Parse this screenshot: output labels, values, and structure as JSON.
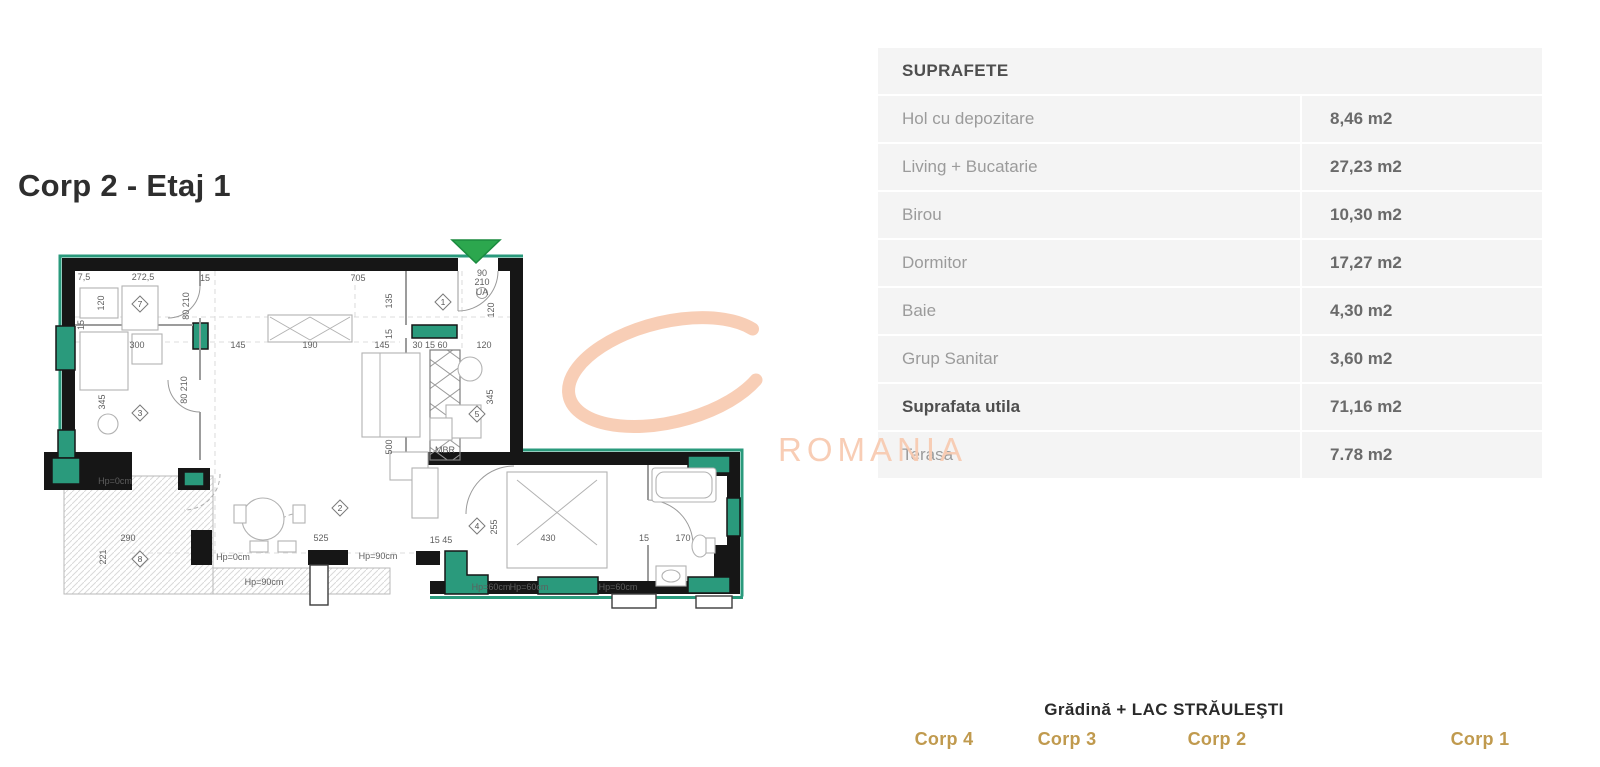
{
  "title": "Corp 2 - Etaj 1",
  "watermark": {
    "text": "ROMANIA"
  },
  "table": {
    "header": "SUPRAFETE",
    "rows": [
      {
        "label": "Hol cu depozitare",
        "value": "8,46 m2",
        "bold": false
      },
      {
        "label": "Living + Bucatarie",
        "value": "27,23 m2",
        "bold": false
      },
      {
        "label": "Birou",
        "value": "10,30 m2",
        "bold": false
      },
      {
        "label": "Dormitor",
        "value": "17,27 m2",
        "bold": false
      },
      {
        "label": "Baie",
        "value": "4,30 m2",
        "bold": false
      },
      {
        "label": "Grup Sanitar",
        "value": "3,60 m2",
        "bold": false
      },
      {
        "label": "Suprafata utila",
        "value": "71,16 m2",
        "bold": true
      },
      {
        "label": "Terasa",
        "value": "7.78 m2",
        "bold": false
      }
    ]
  },
  "site": {
    "caption": "Grădină + LAC STRĂULEŞTI",
    "caption_x": 1164,
    "corps": [
      {
        "label": "Corp 4",
        "x": 893,
        "y": 549,
        "scale": 1.05,
        "label_x": 944,
        "highlighted": false
      },
      {
        "label": "Corp 3",
        "x": 1002,
        "y": 551,
        "scale": 0.88,
        "label_x": 1067,
        "highlighted": false
      },
      {
        "label": "Corp 2",
        "x": 1150,
        "y": 552,
        "scale": 0.8,
        "label_x": 1217,
        "highlighted": true
      },
      {
        "label": "Corp 1",
        "x": 1398,
        "y": 549,
        "scale": 0.82,
        "label_x": 1480,
        "highlighted": false
      }
    ]
  },
  "floorplan": {
    "entrance_icon": "entrance-triangle",
    "rooms": [
      {
        "n": "1",
        "x": 443,
        "y": 302
      },
      {
        "n": "2",
        "x": 340,
        "y": 508
      },
      {
        "n": "3",
        "x": 140,
        "y": 413
      },
      {
        "n": "4",
        "x": 477,
        "y": 526
      },
      {
        "n": "5",
        "x": 477,
        "y": 414
      },
      {
        "n": "7",
        "x": 140,
        "y": 304
      },
      {
        "n": "8",
        "x": 140,
        "y": 559
      }
    ],
    "dims": [
      {
        "t": "7,5",
        "x": 84,
        "y": 280
      },
      {
        "t": "272,5",
        "x": 143,
        "y": 280
      },
      {
        "t": "15",
        "x": 205,
        "y": 281
      },
      {
        "t": "705",
        "x": 358,
        "y": 281
      },
      {
        "t": "120",
        "x": 104,
        "y": 303,
        "r": -90
      },
      {
        "t": "135",
        "x": 392,
        "y": 301,
        "r": -90
      },
      {
        "t": "90",
        "x": 482,
        "y": 276,
        "s": 7
      },
      {
        "t": "210",
        "x": 482,
        "y": 285,
        "s": 7
      },
      {
        "t": "UA",
        "x": 482,
        "y": 295,
        "s": 5
      },
      {
        "t": "120",
        "x": 494,
        "y": 310,
        "r": -90
      },
      {
        "t": "15",
        "x": 84,
        "y": 325,
        "r": -90,
        "s": 7
      },
      {
        "t": "300",
        "x": 137,
        "y": 348
      },
      {
        "t": "145",
        "x": 238,
        "y": 348
      },
      {
        "t": "190",
        "x": 310,
        "y": 348
      },
      {
        "t": "145",
        "x": 382,
        "y": 348
      },
      {
        "t": "30 15 60",
        "x": 430,
        "y": 348,
        "s": 8
      },
      {
        "t": "120",
        "x": 484,
        "y": 348
      },
      {
        "t": "15",
        "x": 392,
        "y": 334,
        "r": -90,
        "s": 8
      },
      {
        "t": "345",
        "x": 105,
        "y": 402,
        "r": -90
      },
      {
        "t": "80 210",
        "x": 189,
        "y": 306,
        "r": -90,
        "s": 7
      },
      {
        "t": "80 210",
        "x": 187,
        "y": 390,
        "r": -90,
        "s": 7
      },
      {
        "t": "345",
        "x": 493,
        "y": 397,
        "r": -90
      },
      {
        "t": "500",
        "x": 392,
        "y": 447,
        "r": -90
      },
      {
        "t": "MBR",
        "x": 445,
        "y": 453,
        "s": 6
      },
      {
        "t": "Hp=0cm",
        "x": 115,
        "y": 484,
        "s": 7
      },
      {
        "t": "290",
        "x": 128,
        "y": 541
      },
      {
        "t": "221",
        "x": 106,
        "y": 557,
        "r": -90
      },
      {
        "t": "Hp=0cm",
        "x": 233,
        "y": 560,
        "s": 7
      },
      {
        "t": "525",
        "x": 321,
        "y": 541
      },
      {
        "t": "Hp=90cm",
        "x": 378,
        "y": 559,
        "s": 7
      },
      {
        "t": "Hp=90cm",
        "x": 264,
        "y": 585,
        "s": 7
      },
      {
        "t": "15 45",
        "x": 441,
        "y": 543,
        "s": 8
      },
      {
        "t": "255",
        "x": 497,
        "y": 527,
        "r": -90
      },
      {
        "t": "430",
        "x": 548,
        "y": 541
      },
      {
        "t": "15",
        "x": 644,
        "y": 541,
        "s": 8
      },
      {
        "t": "170",
        "x": 683,
        "y": 541
      },
      {
        "t": "Hp=60cm",
        "x": 491,
        "y": 590,
        "s": 7
      },
      {
        "t": "Hp=60cm",
        "x": 529,
        "y": 590,
        "s": 7
      },
      {
        "t": "Hp=60cm",
        "x": 618,
        "y": 590,
        "s": 7
      }
    ]
  },
  "colors": {
    "teal": "#2a9a7c",
    "wall": "#161616",
    "green": "#2ca74e",
    "gold": "#c09a4e",
    "tan": "#dcbb7d",
    "salmon": "#f8cbb2",
    "tablebg": "#f4f4f4"
  }
}
